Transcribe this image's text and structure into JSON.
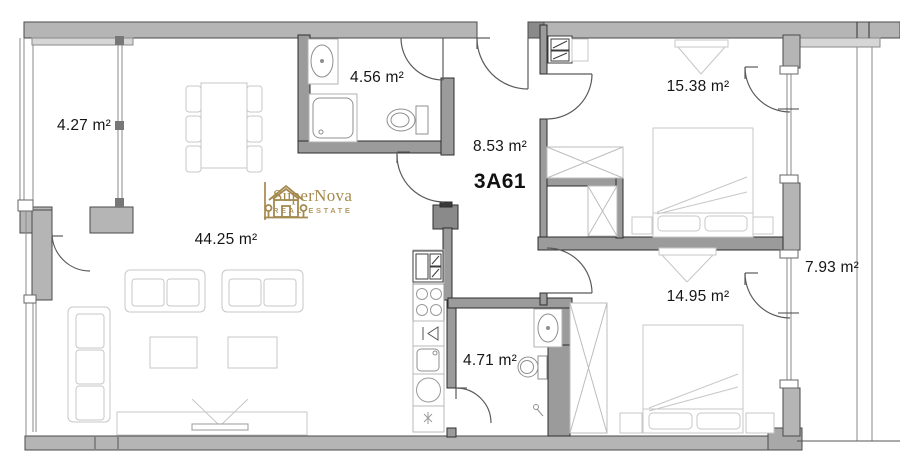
{
  "unit_label": "3A61",
  "brand": {
    "name": "SuperNova",
    "tagline": "REAL ESTATE",
    "color": "#A58A4F"
  },
  "rooms": {
    "balcony_left": "4.27 m²",
    "bathroom_top": "4.56 m²",
    "hallway": "8.53 m²",
    "bedroom_top": "15.38 m²",
    "living_dining_kitchen": "44.25 m²",
    "bathroom_bottom": "4.71 m²",
    "bedroom_bottom": "14.95 m²",
    "balcony_right": "7.93 m²"
  },
  "colors": {
    "wall_exterior": "#b5b5b5",
    "wall_interior": "#9b9b9b",
    "furniture_line": "#c7c7c7",
    "fixture_line": "#8f8f8f",
    "brand_gold": "#A58A4F"
  }
}
